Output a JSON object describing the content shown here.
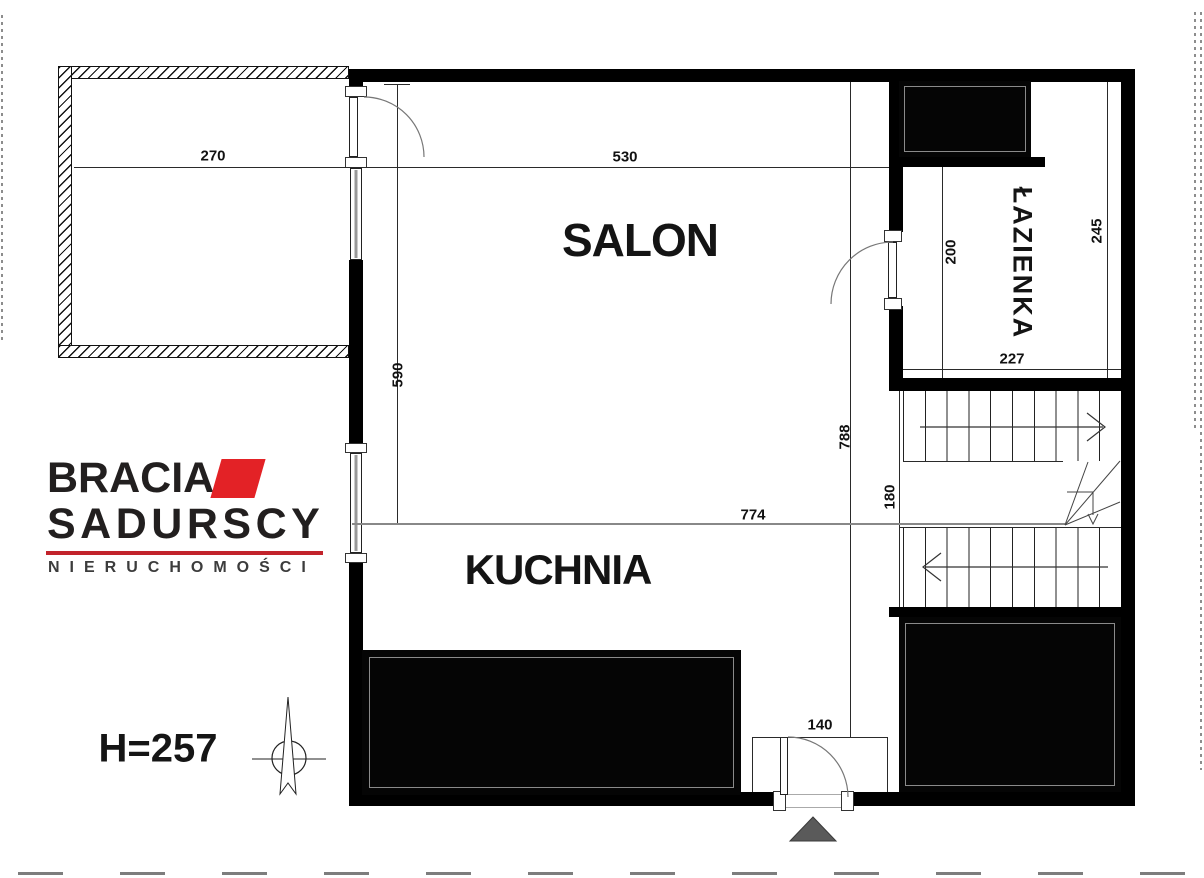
{
  "rooms": {
    "salon": "SALON",
    "kuchnia": "KUCHNIA",
    "lazienka": "ŁAZIENKA"
  },
  "dimensions": {
    "balcony_width": "270",
    "salon_width": "530",
    "salon_depth": "590",
    "kitchen_width": "774",
    "apartment_depth": "788",
    "stair_landing": "180",
    "bathroom_depth": "200",
    "bathroom_total_depth": "245",
    "bathroom_width": "227",
    "entrance_width": "140"
  },
  "annotations": {
    "ceiling_height": "H=257"
  },
  "logo": {
    "name_line1": "BRACIA",
    "name_line2": "SADURSCY",
    "tagline": "NIERUCHOMOŚCI",
    "accent_red": "#e32226",
    "underline_red": "#c2232b",
    "text_black": "#221f1f"
  },
  "colors": {
    "wall": "#000000",
    "thin_line": "#2a2a2a",
    "dim_text": "#111111",
    "background": "#ffffff",
    "entrance_marker": "#5a5a5a",
    "window_core": "#999999"
  }
}
